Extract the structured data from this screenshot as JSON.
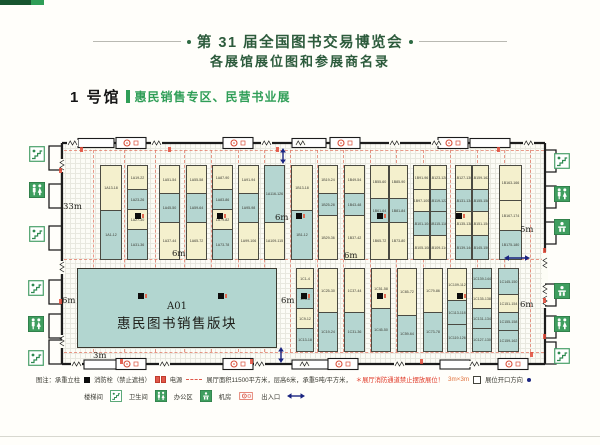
{
  "header": {
    "title": "第 31 届全国图书交易博览会",
    "subtitle": "各展馆展位图和参展商名录"
  },
  "hall": {
    "name": "1 号馆",
    "theme": "惠民销售专区、民营书业展"
  },
  "plan": {
    "a01": {
      "code": "A01",
      "name": "惠民图书销售版块"
    },
    "colors": {
      "cream": "#f4f0cd",
      "teal": "#b5d6d1",
      "wall": "#1c1c1c",
      "lane": "#e0705c",
      "green": "#2f9e57",
      "dark_green": "#2d5b3c",
      "blue": "#1a2480",
      "red": "#e04a38"
    },
    "dim_labels": [
      {
        "text": "33m",
        "x": 63,
        "y": 202
      },
      {
        "text": "6m",
        "x": 172,
        "y": 249
      },
      {
        "text": "6m",
        "x": 275,
        "y": 213
      },
      {
        "text": "6m",
        "x": 344,
        "y": 251
      },
      {
        "text": "5m",
        "x": 520,
        "y": 225
      },
      {
        "text": "6m",
        "x": 62,
        "y": 296
      },
      {
        "text": "6m",
        "x": 281,
        "y": 296
      },
      {
        "text": "6m",
        "x": 520,
        "y": 300
      },
      {
        "text": "3m",
        "x": 93,
        "y": 351
      }
    ],
    "top_columns": [
      {
        "x": 100,
        "w": 22,
        "cells": [
          {
            "label": "1A13-18",
            "color": "cream",
            "h": 45
          },
          {
            "label": "1A1-12",
            "color": "teal",
            "h": 48
          }
        ]
      },
      {
        "x": 127,
        "w": 21,
        "cells": [
          {
            "label": "1A19-22",
            "color": "cream",
            "h": 24
          },
          {
            "label": "1A23-26",
            "color": "teal",
            "h": 20
          },
          {
            "label": "1A27-30",
            "color": "cream",
            "h": 20
          },
          {
            "label": "1A31-36",
            "color": "teal",
            "h": 29
          }
        ]
      },
      {
        "x": 159,
        "w": 21,
        "cells": [
          {
            "label": "1A51-54",
            "color": "cream",
            "h": 28
          },
          {
            "label": "1A45-50",
            "color": "teal",
            "h": 29
          },
          {
            "label": "1A37-44",
            "color": "cream",
            "h": 36
          }
        ]
      },
      {
        "x": 186,
        "w": 21,
        "cells": [
          {
            "label": "1A55-58",
            "color": "cream",
            "h": 28
          },
          {
            "label": "1A59-64",
            "color": "teal",
            "h": 29
          },
          {
            "label": "1A65-72",
            "color": "cream",
            "h": 36
          }
        ]
      },
      {
        "x": 212,
        "w": 21,
        "cells": [
          {
            "label": "1A87-90",
            "color": "cream",
            "h": 24
          },
          {
            "label": "1A83-86",
            "color": "teal",
            "h": 20
          },
          {
            "label": "1A79-82",
            "color": "cream",
            "h": 20
          },
          {
            "label": "1A73-78",
            "color": "teal",
            "h": 29
          }
        ]
      },
      {
        "x": 238,
        "w": 21,
        "cells": [
          {
            "label": "1A91-94",
            "color": "cream",
            "h": 28
          },
          {
            "label": "1A95-98",
            "color": "teal",
            "h": 29
          },
          {
            "label": "1A99-106",
            "color": "cream",
            "h": 36
          }
        ]
      },
      {
        "x": 264,
        "w": 21,
        "cells": [
          {
            "label": "1A116-126",
            "color": "teal",
            "h": 57
          },
          {
            "label": "1A109-115",
            "color": "cream",
            "h": 36
          }
        ]
      },
      {
        "x": 291,
        "w": 22,
        "cells": [
          {
            "label": "1B13-18",
            "color": "cream",
            "h": 45
          },
          {
            "label": "1B1-12",
            "color": "teal",
            "h": 48
          }
        ]
      },
      {
        "x": 318,
        "w": 20,
        "cells": [
          {
            "label": "1B19-24",
            "color": "cream",
            "h": 28
          },
          {
            "label": "1B25-28",
            "color": "teal",
            "h": 22
          },
          {
            "label": "1B29-36",
            "color": "cream",
            "h": 43
          }
        ]
      },
      {
        "x": 344,
        "w": 21,
        "cells": [
          {
            "label": "1B49-54",
            "color": "cream",
            "h": 28
          },
          {
            "label": "1B43-48",
            "color": "teal",
            "h": 22
          },
          {
            "label": "1B37-42",
            "color": "cream",
            "h": 43
          }
        ]
      },
      {
        "x": 370,
        "w": 19,
        "cells": [
          {
            "label": "1B55-60",
            "color": "cream",
            "h": 33
          },
          {
            "label": "1B61-64",
            "color": "teal",
            "h": 24
          },
          {
            "label": "1B65-72",
            "color": "cream",
            "h": 36
          }
        ]
      },
      {
        "x": 389,
        "w": 19,
        "cells": [
          {
            "label": "1B85-90",
            "color": "cream",
            "h": 33
          },
          {
            "label": "1B81-84",
            "color": "teal",
            "h": 24
          },
          {
            "label": "1B73-80",
            "color": "cream",
            "h": 36
          }
        ]
      },
      {
        "x": 413,
        "w": 17,
        "cells": [
          {
            "label": "1B91-96",
            "color": "cream",
            "h": 24
          },
          {
            "label": "1B97-100",
            "color": "cream",
            "h": 22
          },
          {
            "label": "1B101-104",
            "color": "teal",
            "h": 24
          },
          {
            "label": "1B105-108",
            "color": "cream",
            "h": 23
          }
        ]
      },
      {
        "x": 430,
        "w": 17,
        "cells": [
          {
            "label": "1B123-128",
            "color": "cream",
            "h": 24
          },
          {
            "label": "1B119-122",
            "color": "teal",
            "h": 22
          },
          {
            "label": "1B115-118",
            "color": "teal",
            "h": 24
          },
          {
            "label": "1B109-114",
            "color": "cream",
            "h": 23
          }
        ]
      },
      {
        "x": 455,
        "w": 17,
        "cells": [
          {
            "label": "1B127-130",
            "color": "cream",
            "h": 24
          },
          {
            "label": "1B131-134",
            "color": "teal",
            "h": 22
          },
          {
            "label": "1B135-138",
            "color": "cream",
            "h": 24
          },
          {
            "label": "1B139-144",
            "color": "teal",
            "h": 23
          }
        ]
      },
      {
        "x": 472,
        "w": 17,
        "cells": [
          {
            "label": "1B159-162",
            "color": "cream",
            "h": 24
          },
          {
            "label": "1B155-158",
            "color": "teal",
            "h": 22
          },
          {
            "label": "1B151-154",
            "color": "cream",
            "h": 24
          },
          {
            "label": "1B145-150",
            "color": "teal",
            "h": 23
          }
        ]
      },
      {
        "x": 499,
        "w": 23,
        "cells": [
          {
            "label": "1B163-166",
            "color": "cream",
            "h": 35
          },
          {
            "label": "1B167-174",
            "color": "cream",
            "h": 30
          },
          {
            "label": "1B175-180",
            "color": "teal",
            "h": 28
          }
        ]
      }
    ],
    "bottom_columns": [
      {
        "x": 296,
        "w": 18,
        "cells": [
          {
            "label": "1C1-4",
            "color": "cream",
            "h": 20
          },
          {
            "label": "1C5-8",
            "color": "teal",
            "h": 20
          },
          {
            "label": "1C9-12",
            "color": "cream",
            "h": 20
          },
          {
            "label": "1C13-18",
            "color": "teal",
            "h": 22
          }
        ]
      },
      {
        "x": 318,
        "w": 20,
        "cells": [
          {
            "label": "1C25-30",
            "color": "cream",
            "h": 44
          },
          {
            "label": "1C19-24",
            "color": "teal",
            "h": 38
          }
        ]
      },
      {
        "x": 344,
        "w": 21,
        "cells": [
          {
            "label": "1C37-44",
            "color": "cream",
            "h": 44
          },
          {
            "label": "1C31-36",
            "color": "teal",
            "h": 38
          }
        ]
      },
      {
        "x": 371,
        "w": 20,
        "cells": [
          {
            "label": "1C51-58",
            "color": "cream",
            "h": 40
          },
          {
            "label": "1C45-50",
            "color": "teal",
            "h": 42
          }
        ]
      },
      {
        "x": 397,
        "w": 20,
        "cells": [
          {
            "label": "1C65-72",
            "color": "cream",
            "h": 47
          },
          {
            "label": "1C59-64",
            "color": "teal",
            "h": 35
          }
        ]
      },
      {
        "x": 423,
        "w": 20,
        "cells": [
          {
            "label": "1C79-86",
            "color": "cream",
            "h": 44
          },
          {
            "label": "1C73-78",
            "color": "teal",
            "h": 38
          }
        ]
      },
      {
        "x": 447,
        "w": 20,
        "cells": [
          {
            "label": "1C109-112",
            "color": "cream",
            "h": 32
          },
          {
            "label": "1C113-118",
            "color": "teal",
            "h": 24
          },
          {
            "label": "1C119-126",
            "color": "teal",
            "h": 26
          }
        ]
      },
      {
        "x": 472,
        "w": 20,
        "cells": [
          {
            "label": "1C139-144",
            "color": "teal",
            "h": 20
          },
          {
            "label": "1C135-138",
            "color": "cream",
            "h": 20
          },
          {
            "label": "1C131-134",
            "color": "teal",
            "h": 20
          },
          {
            "label": "1C127-130",
            "color": "teal",
            "h": 22
          }
        ]
      },
      {
        "x": 498,
        "w": 21,
        "cells": [
          {
            "label": "1C145-150",
            "color": "teal",
            "h": 26
          },
          {
            "label": "1C151-154",
            "color": "cream",
            "h": 18
          },
          {
            "label": "1C155-158",
            "color": "teal",
            "h": 18
          },
          {
            "label": "1C159-162",
            "color": "teal",
            "h": 20
          }
        ]
      }
    ],
    "pillars": [
      {
        "x": 135,
        "y": 213
      },
      {
        "x": 217,
        "y": 213
      },
      {
        "x": 296,
        "y": 213
      },
      {
        "x": 377,
        "y": 213
      },
      {
        "x": 456,
        "y": 213
      },
      {
        "x": 138,
        "y": 293
      },
      {
        "x": 218,
        "y": 293
      },
      {
        "x": 301,
        "y": 293
      },
      {
        "x": 377,
        "y": 293
      },
      {
        "x": 457,
        "y": 293
      }
    ],
    "side_icons": [
      {
        "type": "stair",
        "x": 29,
        "y": 146
      },
      {
        "type": "wc",
        "x": 29,
        "y": 182
      },
      {
        "type": "stair",
        "x": 29,
        "y": 226
      },
      {
        "type": "stair",
        "x": 28,
        "y": 280
      },
      {
        "type": "wc",
        "x": 28,
        "y": 316
      },
      {
        "type": "stair",
        "x": 28,
        "y": 350
      },
      {
        "type": "stair",
        "x": 554,
        "y": 153
      },
      {
        "type": "wc",
        "x": 554,
        "y": 186
      },
      {
        "type": "office",
        "x": 554,
        "y": 219
      },
      {
        "type": "office",
        "x": 554,
        "y": 283
      },
      {
        "type": "wc",
        "x": 554,
        "y": 316
      },
      {
        "type": "stair",
        "x": 554,
        "y": 348
      }
    ]
  },
  "legend": {
    "row1": {
      "prefix": "图注：承重立柱",
      "hydrant": "消防栓（禁止遮挡）",
      "power": "电源",
      "hall_info": "展厅面积11500平方米，层高6米，承重5吨/平方米，",
      "warning": "＊展厅消防通道禁止摆放展位！",
      "size": "3m×3m",
      "opening": "展位开口方向"
    },
    "row2": {
      "stair": "楼梯间",
      "wc": "卫生间",
      "office": "办公区",
      "machine": "机房",
      "exit": "出入口"
    }
  }
}
